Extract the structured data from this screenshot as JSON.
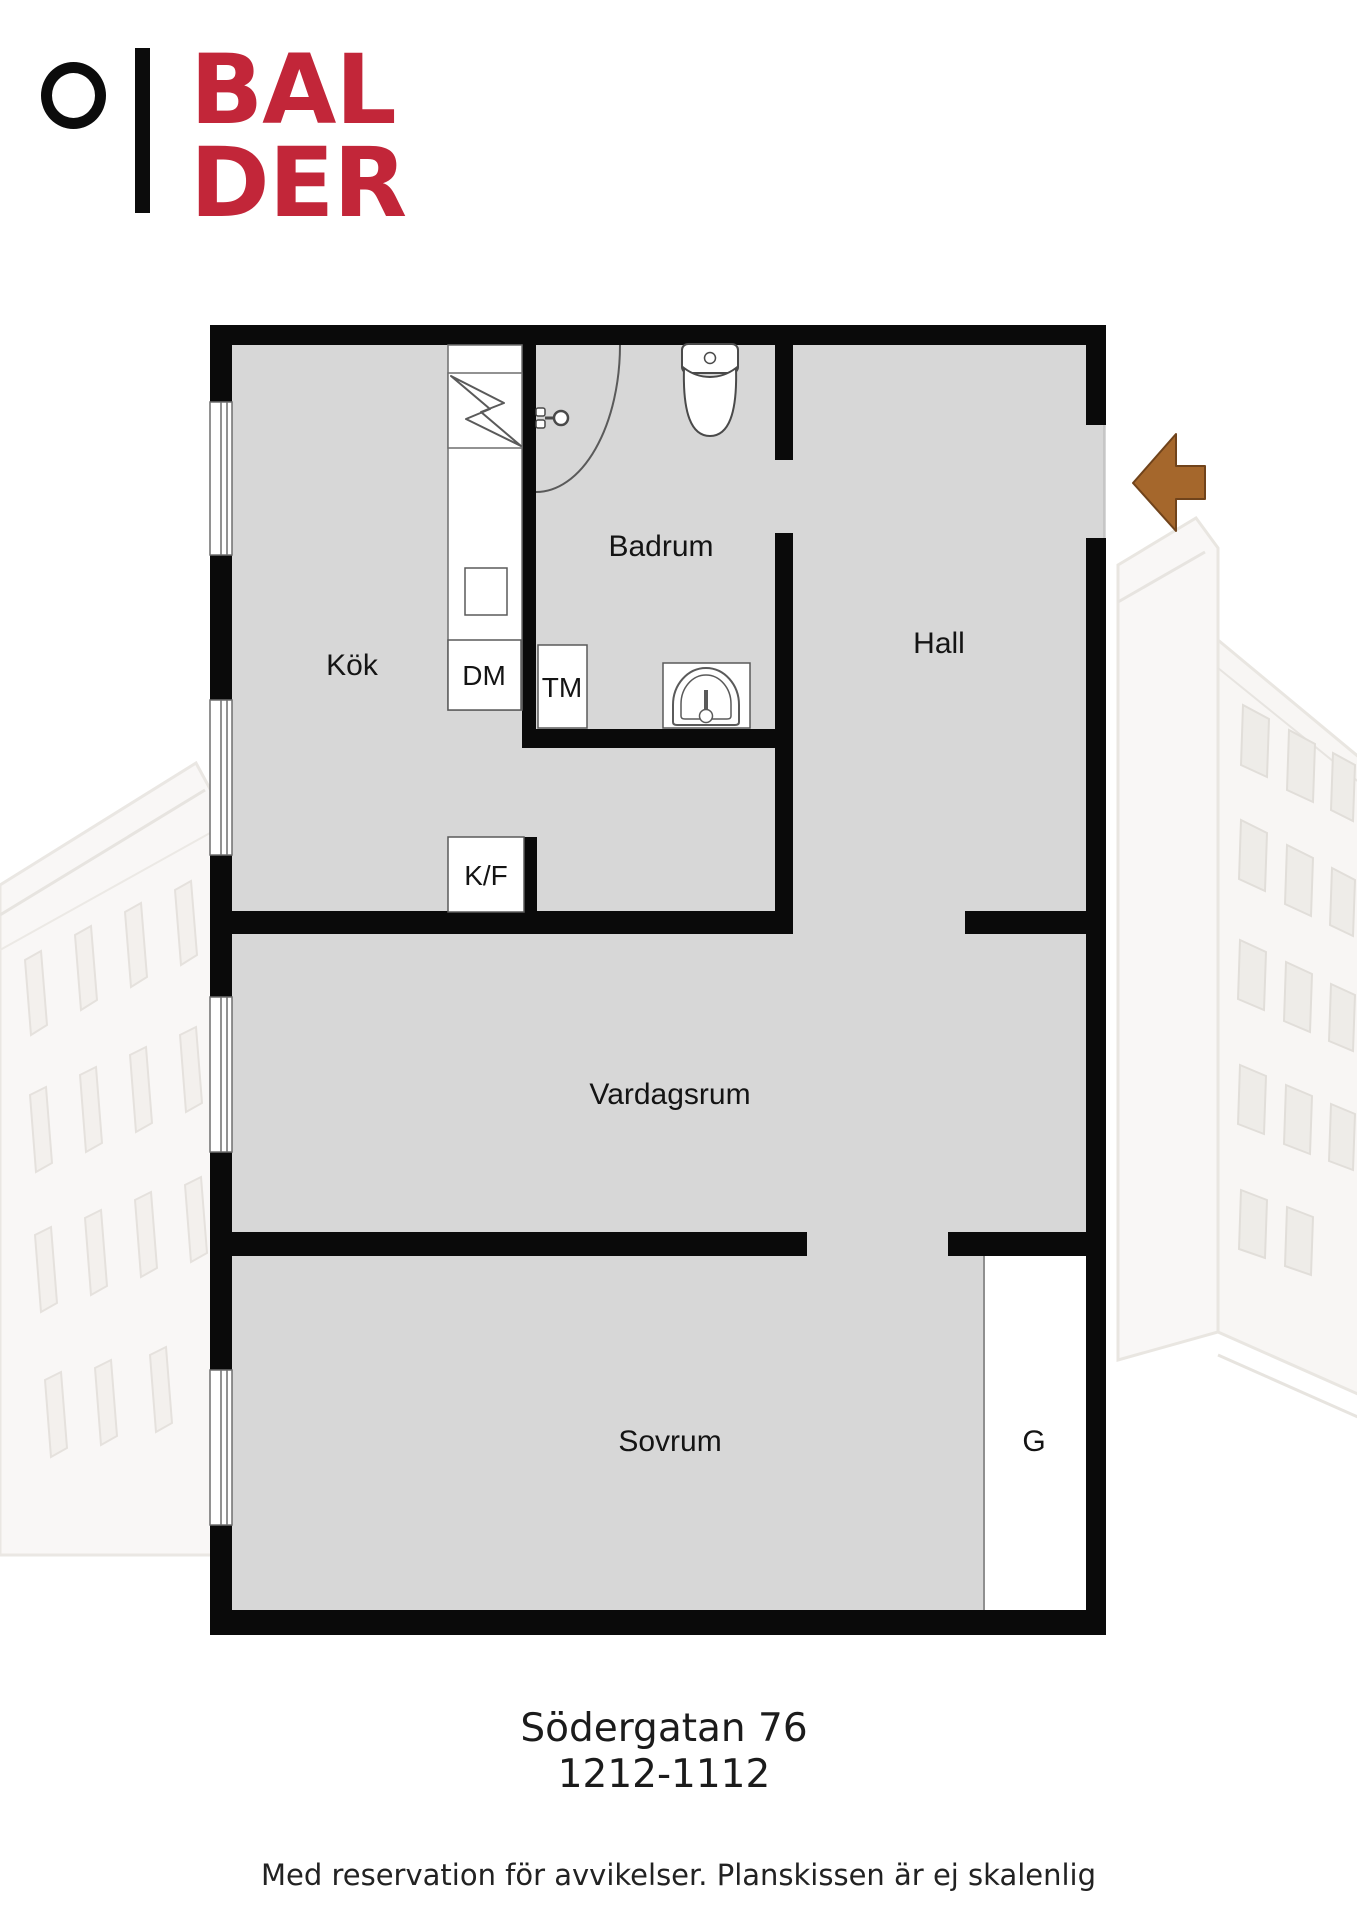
{
  "logo": {
    "line1": "BAL",
    "line2": "DER",
    "brand_color": "#c22639"
  },
  "floorplan": {
    "rooms": {
      "kok": "Kök",
      "badrum": "Badrum",
      "hall": "Hall",
      "vardagsrum": "Vardagsrum",
      "sovrum": "Sovrum"
    },
    "fixtures": {
      "dishwasher": "DM",
      "washing_machine": "TM",
      "fridge_freezer": "K/F",
      "wardrobe": "G"
    },
    "colors": {
      "wall": "#0a0a0a",
      "floor": "#d7d7d7",
      "fixture_line": "#5a5a5a",
      "entry_arrow": "#a5672c",
      "entry_arrow_outline": "#70431b"
    }
  },
  "footer": {
    "address_line1": "Södergatan 76",
    "address_line2": "1212-1112",
    "disclaimer": "Med reservation för avvikelser. Planskissen är ej skalenlig"
  }
}
